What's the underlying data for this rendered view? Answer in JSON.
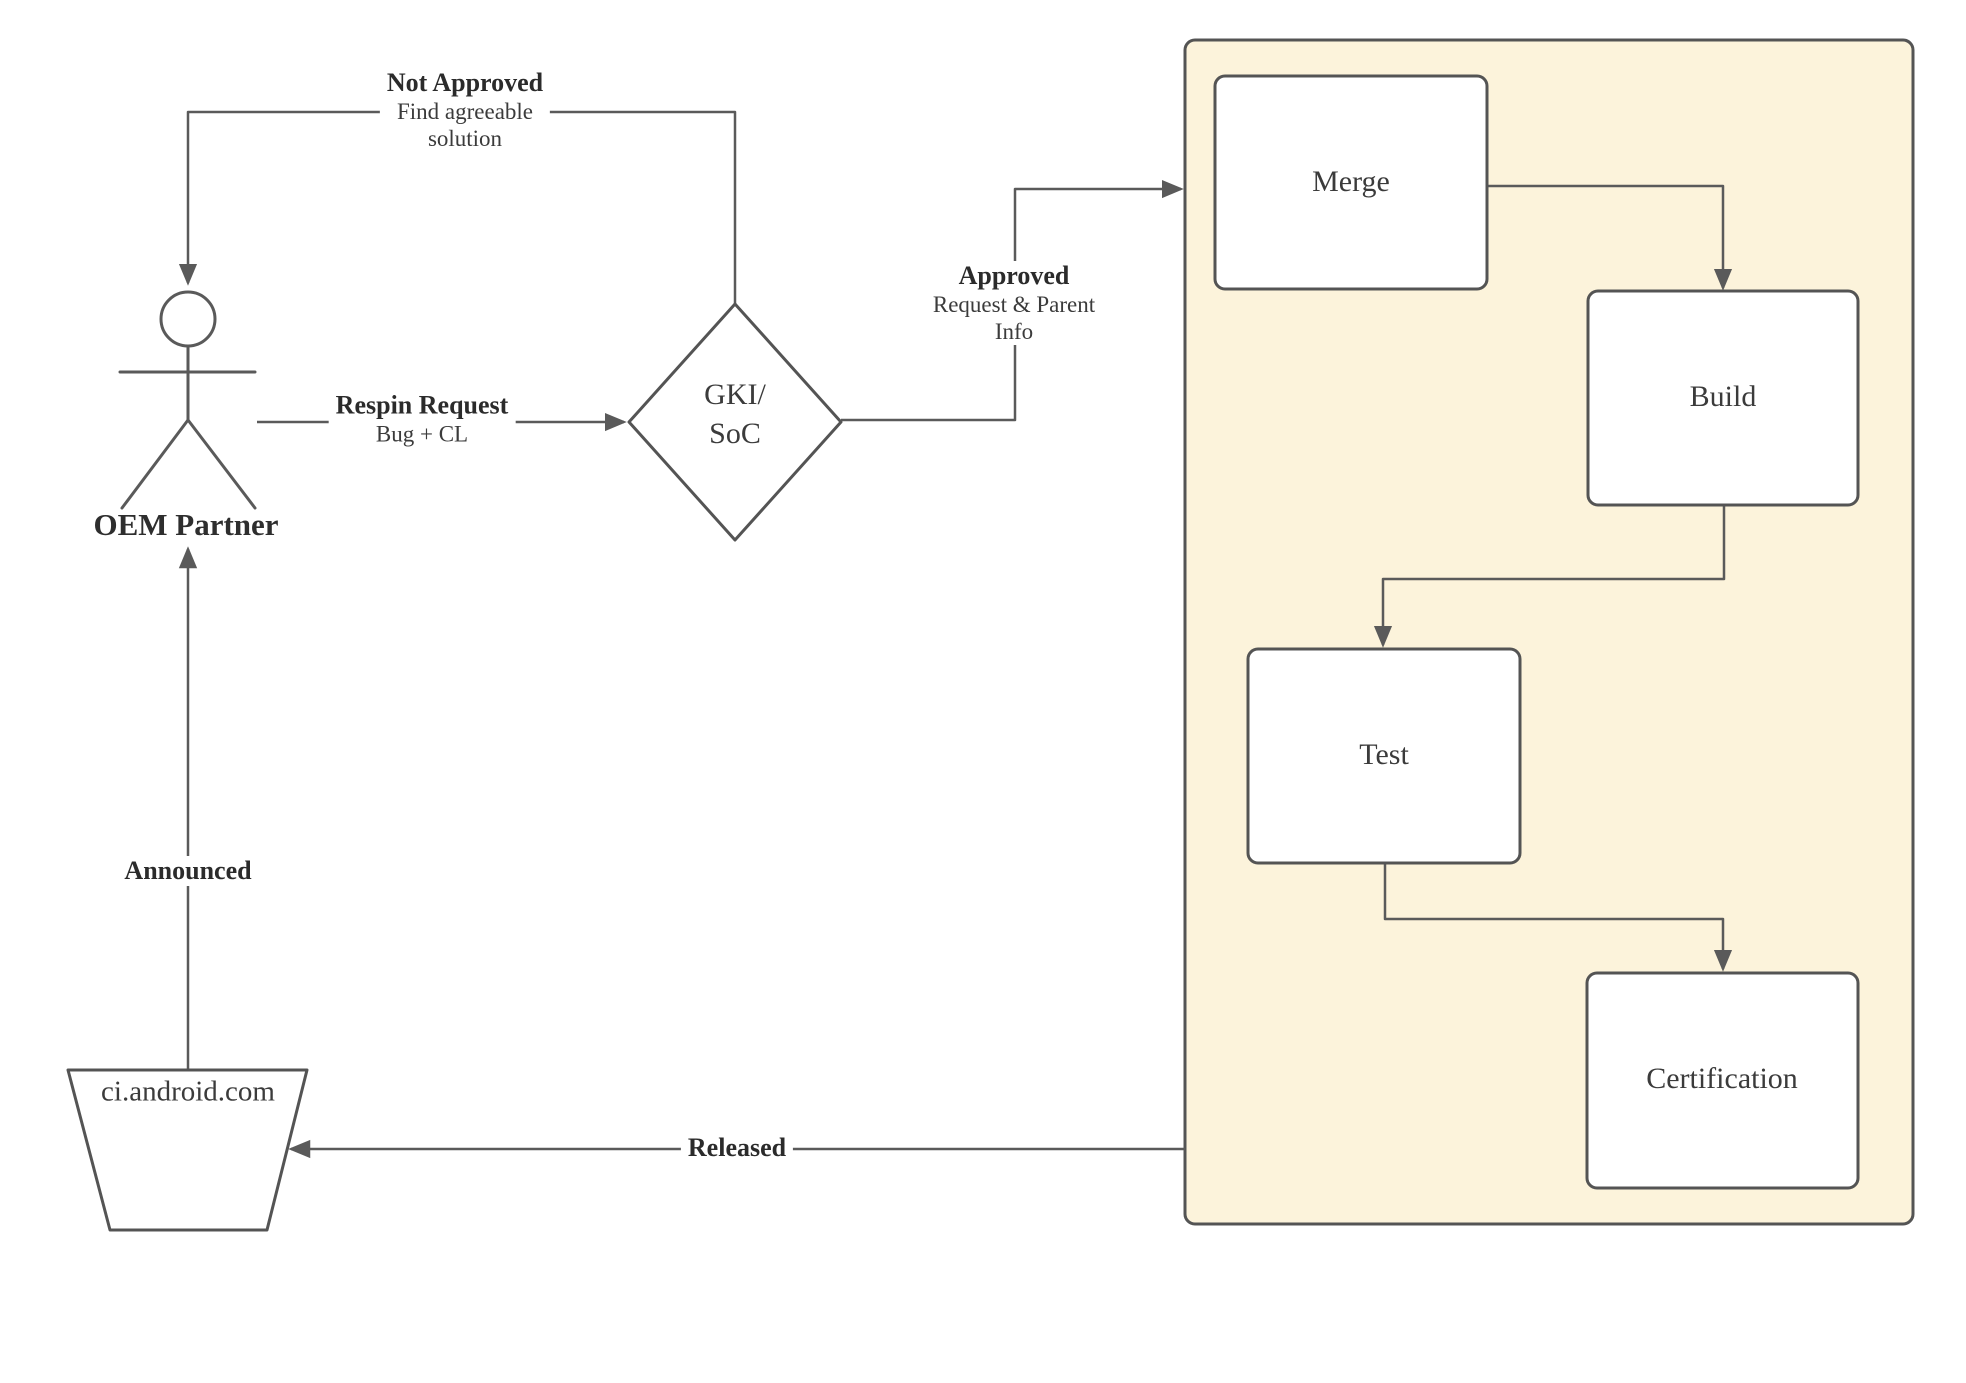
{
  "diagram_type": "flowchart",
  "nodes": {
    "oem_partner": {
      "label": "OEM Partner"
    },
    "gki_soc": {
      "line1": "GKI/",
      "line2": "SoC"
    },
    "ci_android": {
      "label": "ci.android.com"
    },
    "merge": {
      "label": "Merge"
    },
    "build": {
      "label": "Build"
    },
    "test": {
      "label": "Test"
    },
    "certification": {
      "label": "Certification"
    }
  },
  "edges": {
    "not_approved": {
      "title": "Not Approved",
      "line1": "Find agreeable",
      "line2": "solution"
    },
    "respin_request": {
      "title": "Respin Request",
      "line1": "Bug + CL"
    },
    "approved": {
      "title": "Approved",
      "line1": "Request & Parent",
      "line2": "Info"
    },
    "announced": {
      "title": "Announced"
    },
    "released": {
      "title": "Released"
    }
  },
  "colors": {
    "container_fill": "#fcf3db",
    "shape_fill": "#ffffff",
    "shape_border": "#545454",
    "connector": "#5a5a5a",
    "text": "#333333"
  }
}
